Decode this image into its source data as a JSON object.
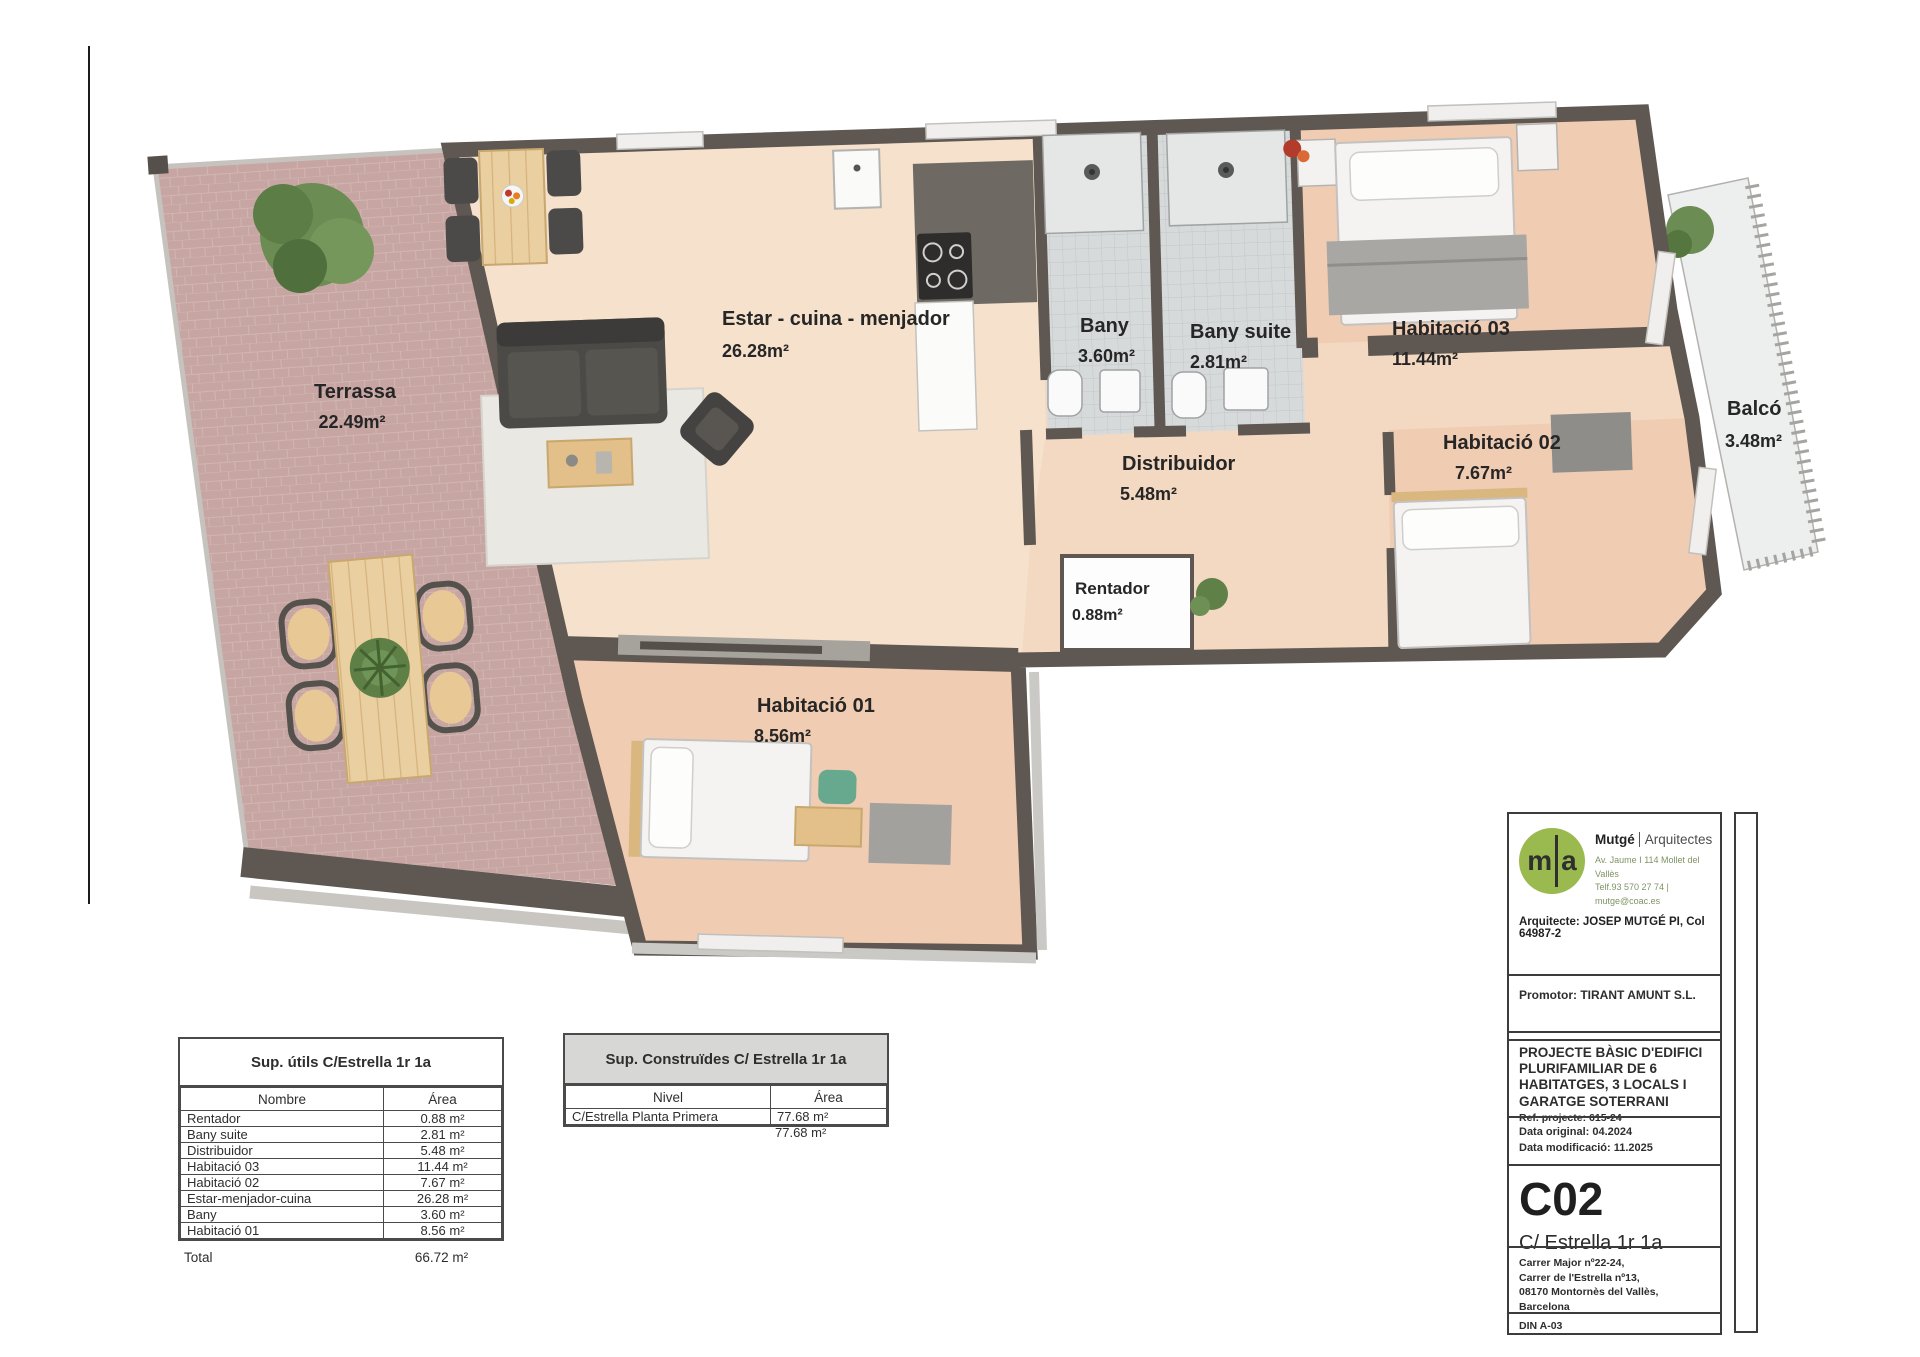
{
  "plan": {
    "rooms": [
      {
        "id": "terrassa",
        "name": "Terrassa",
        "area": "22.49m²"
      },
      {
        "id": "estar-cuina-menjador",
        "name": "Estar - cuina - menjador",
        "area": "26.28m²"
      },
      {
        "id": "bany",
        "name": "Bany",
        "area": "3.60m²"
      },
      {
        "id": "bany-suite",
        "name": "Bany suite",
        "area": "2.81m²"
      },
      {
        "id": "habitacio-03",
        "name": "Habitació 03",
        "area": "11.44m²"
      },
      {
        "id": "habitacio-02",
        "name": "Habitació 02",
        "area": "7.67m²"
      },
      {
        "id": "balco",
        "name": "Balcó",
        "area": "3.48m²"
      },
      {
        "id": "distribuidor",
        "name": "Distribuidor",
        "area": "5.48m²"
      },
      {
        "id": "rentador",
        "name": "Rentador",
        "area": "0.88m²"
      },
      {
        "id": "habitacio-01",
        "name": "Habitació 01",
        "area": "8.56m²"
      }
    ]
  },
  "useful_areas_table": {
    "title": "Sup. útils C/Estrella 1r 1a",
    "columns": [
      "Nombre",
      "Área"
    ],
    "rows": [
      [
        "Rentador",
        "0.88 m²"
      ],
      [
        "Bany suite",
        "2.81 m²"
      ],
      [
        "Distribuidor",
        "5.48 m²"
      ],
      [
        "Habitació 03",
        "11.44 m²"
      ],
      [
        "Habitació 02",
        "7.67 m²"
      ],
      [
        "Estar-menjador-cuina",
        "26.28 m²"
      ],
      [
        "Bany",
        "3.60 m²"
      ],
      [
        "Habitació 01",
        "8.56 m²"
      ]
    ],
    "total_label": "Total",
    "total_value": "66.72 m²"
  },
  "built_areas_table": {
    "title": "Sup. Construïdes C/ Estrella 1r 1a",
    "columns": [
      "Nivel",
      "Área"
    ],
    "rows": [
      [
        "C/Estrella Planta Primera",
        "77.68 m²"
      ]
    ],
    "total_value": "77.68 m²"
  },
  "title_block": {
    "logo": {
      "left": "m",
      "right": "a"
    },
    "firm_name": "Mutgé",
    "firm_kind": "Arquitectes",
    "firm_address": "Av. Jaume I  114 Mollet del Vallès",
    "firm_contact": "Telf.93 570 27 74  |  mutge@coac.es",
    "architect": "Arquitecte: JOSEP MUTGÉ PI, Col 64987-2",
    "promoter": "Promotor: TIRANT AMUNT S.L.",
    "project_title": "PROJECTE BÀSIC D'EDIFICI PLURIFAMILIAR DE 6 HABITATGES, 3 LOCALS I GARATGE SOTERRANI",
    "project_ref": "Ref. projecte: 615-24",
    "date_original": "Data original: 04.2024",
    "date_modified": "Data modificació: 11.2025",
    "plan_code": "C02",
    "plan_name": "C/ Estrella 1r 1a",
    "site_address_lines": [
      "Carrer Major nº22-24,",
      "Carrer de l'Estrella nº13,",
      "08170 Montornès del Vallès, Barcelona"
    ],
    "paper_format": "DIN A-03"
  }
}
